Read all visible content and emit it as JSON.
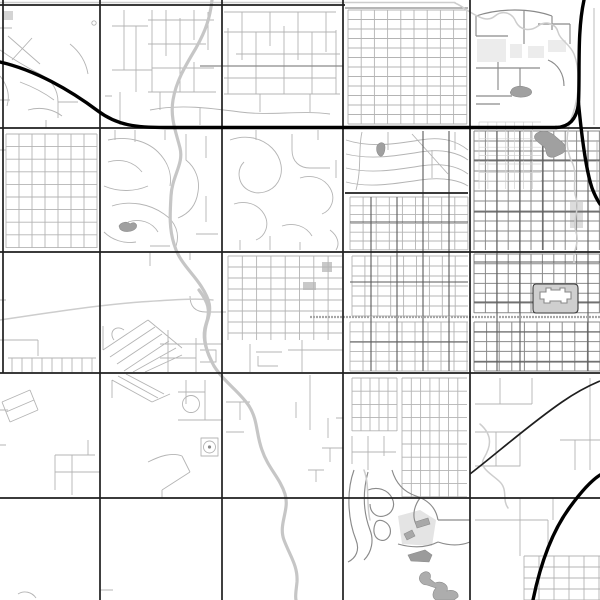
{
  "map": {
    "canvas": {
      "width": 600,
      "height": 600,
      "background": "#ffffff"
    },
    "palette": {
      "minor_street": "#b4b4b4",
      "mid_street": "#8a8a8a",
      "dark_street": "#5a5a5a",
      "major_road": "#1f1f1f",
      "highway": "#000000",
      "river": "#c6c6c6",
      "stream": "#cdcdcd",
      "rail": "#a6a6a6",
      "water_fill": "#a0a0a0",
      "area_fill": "#ececec",
      "building_fill": "#cfcfcf",
      "dark_structure": "#9b9b9b"
    },
    "layers": [
      {
        "name": "area-fills-layer",
        "kind": "fill",
        "fill": "#ececec",
        "items": [
          {
            "d": "M477 39 H506 V62 H477 Z"
          },
          {
            "d": "M510 44 H522 V58 H510 Z"
          },
          {
            "d": "M528 46 H544 V58 H528 Z"
          },
          {
            "d": "M548 40 H566 V52 H548 Z"
          },
          {
            "d": "M570 202 H583 V228 H570 Z",
            "f": "#dcdcdc"
          },
          {
            "d": "M3 11 H13 V20 H3 Z",
            "f": "#d4d4d4"
          },
          {
            "d": "M303 282 H316 V290 H303 Z",
            "f": "#c9c9c9"
          },
          {
            "d": "M322 262 H332 V272 H322 Z",
            "f": "#c9c9c9"
          },
          {
            "d": "M398 516 L420 510 L436 520 L432 546 L402 544 Z",
            "f": "#e4e4e4"
          }
        ]
      },
      {
        "name": "street-grids-layer",
        "kind": "grid",
        "stroke": "#b4b4b4",
        "width": 0.9,
        "items": [
          {
            "x0": 348,
            "y0": 10,
            "x1": 467,
            "y1": 124,
            "dx": 13.2,
            "dy": 9.5
          },
          {
            "x0": 350,
            "y0": 197,
            "x1": 468,
            "y1": 250,
            "dx": 13.1,
            "dy": 8.8
          },
          {
            "x0": 352,
            "y0": 256,
            "x1": 468,
            "y1": 316,
            "dx": 12.9,
            "dy": 10
          },
          {
            "x0": 350,
            "y0": 322,
            "x1": 468,
            "y1": 371,
            "dx": 13,
            "dy": 9.8
          },
          {
            "x0": 352,
            "y0": 378,
            "x1": 397,
            "y1": 431,
            "dx": 9,
            "dy": 13.2
          },
          {
            "x0": 402,
            "y0": 378,
            "x1": 467,
            "y1": 497,
            "dx": 9.3,
            "dy": 13.2
          },
          {
            "x0": 6,
            "y0": 134,
            "x1": 97,
            "y1": 248,
            "dx": 13,
            "dy": 12.6
          },
          {
            "x0": 524,
            "y0": 556,
            "x1": 600,
            "y1": 600,
            "dx": 15,
            "dy": 11
          },
          {
            "x0": 228,
            "y0": 256,
            "x1": 342,
            "y1": 340,
            "dx": 14.3,
            "dy": 11
          }
        ]
      },
      {
        "name": "downtown-grids-layer",
        "kind": "grid",
        "stroke": "#8a8a8a",
        "width": 1,
        "items": [
          {
            "x0": 474,
            "y0": 131,
            "x1": 600,
            "y1": 250,
            "dx": 11.4,
            "dy": 10
          },
          {
            "x0": 474,
            "y0": 254,
            "x1": 600,
            "y1": 313,
            "dx": 11.4,
            "dy": 9.8
          },
          {
            "x0": 474,
            "y0": 322,
            "x1": 600,
            "y1": 371,
            "dx": 12.6,
            "dy": 9.8
          }
        ]
      },
      {
        "name": "parking-grid-layer",
        "kind": "grid",
        "stroke": "#d2d2d2",
        "width": 0.7,
        "items": [
          {
            "x0": 479,
            "y0": 122,
            "x1": 541,
            "y1": 189,
            "dx": 8.9,
            "dy": 8.4
          }
        ]
      },
      {
        "name": "minor-streets-layer",
        "kind": "stroke",
        "stroke": "#b4b4b4",
        "width": 0.9,
        "items": [
          "M8 36 L40 64 M32 38 L12 60 M0 50 C14 60 28 68 40 74 C52 80 58 90 58 102 V118 M20 82 C36 88 46 94 54 100 M0 76 C8 86 10 96 7 106 M28 110 C42 106 54 110 62 116 M58 102 H78 M70 44 C80 52 86 62 88 74 M0 28 H12 M0 100 H10 M46 120 V128",
          "M152 10 V92 M166 10 V56 M180 18 V92 M194 10 V40 M194 62 V92 M208 12 V50 M124 10 V70 M136 26 V92 M112 26 H148 M112 70 H152 M148 20 H214 M148 44 H206 M152 68 H214 M148 92 H216",
          "M228 28 V94 M242 12 V60 M256 32 V94 M270 12 V46 M284 26 V94 M298 12 V60 M312 32 V94 M326 12 V52 M336 30 V94 M224 12 H336 M224 32 H336 M236 54 H340 M224 78 H336 M224 94 H340",
          "M150 110 C180 104 210 108 240 112 C270 116 300 110 330 114 M160 92 V110 M260 94 V112 M310 94 V112 M120 92 V125 M200 108 V125 M105 96 H112",
          "M108 140 C126 136 146 140 158 152 C168 162 172 174 170 186 M108 162 C122 158 134 162 142 172 M104 186 C118 192 134 192 148 186 M112 206 C130 200 150 204 164 214 C176 222 180 234 176 246 M128 222 C140 218 152 222 158 232 M104 232 C112 240 124 244 136 242 M150 246 H170 M186 134 V160 C196 168 200 180 198 192 C196 206 188 214 178 218 M206 136 V158 M206 196 V222 M196 234 H218 M115 130 V140 M135 130 V142 M165 130 V140",
          "M230 140 C246 134 262 138 272 148 C282 158 284 172 278 182 C272 192 258 196 248 190 C238 184 236 170 244 162 M292 134 V150 C292 162 300 168 310 168 H330 M300 178 C312 174 324 178 330 188 C336 198 332 210 322 214 M234 204 C246 200 258 204 264 214 C270 224 266 236 256 240 M282 226 C294 222 306 226 312 236 M318 140 V130 M256 130 V140 M336 160 V178 M330 230 C338 236 340 244 336 250 M240 250 V240 M300 250 V242 M270 250 V236",
          "M346 140 C370 148 396 144 420 140 C444 136 458 142 468 150 M346 154 C370 160 396 156 420 152 C444 148 460 154 468 160 M346 168 C370 174 396 170 420 166 C446 162 460 168 468 174 M346 182 C368 188 394 184 420 180 C446 176 462 182 468 186 M362 132 C358 148 362 168 356 190 M412 134 L448 174 M388 132 V150 M432 150 V178 M455 132 V150",
          "M190 296 Q190 312 206 312 H226 M103 350 L148 320 M110 357 L155 327 M117 364 L162 334 M124 371 L169 341 M133 372 L176 348 M145 372 L182 355 M103 326 V350 M148 320 L182 348 M114 340 C108 332 116 324 124 330 M168 330 V372 M196 338 V372 M160 344 H222 M160 358 H196 M200 350 H216 V362 H200 M150 252 V266 M190 252 V260",
          "M8 358 H96 M12 358 V372 M22 358 V372 M32 358 V372 M42 358 V372 M52 358 V372 M62 358 V372 M72 358 V372 M82 358 V372 M92 358 V372 M0 340 H38 M38 340 V356 M0 300 H6 M0 150 H6",
          "M250 344 V372 M302 340 V372 M288 350 H343 M256 352 H282 M258 356 V366 H278",
          "M2 402 L30 390 M6 412 L34 400 M10 422 L38 410 M2 402 L10 422 M30 390 L38 410 M55 455 H95 M55 455 V490 M72 455 V495 M55 472 H100 M88 440 V455 M0 410 H8 M0 445 H6",
          "M112 380 L152 402 M118 376 L158 398 M126 374 L164 394 M112 380 V398 M152 402 L170 394 M186 380 V404 M178 392 H205 M205 380 V420 M178 420 H222 M148 462 C160 456 172 452 182 456 M182 456 L190 472 M162 490 L190 472 M162 490 V498 M201 438 H218 V456 H201 Z",
          "M226 402 H250 M240 402 V420 M226 432 H244 M310 375 V430 M296 402 V418 M336 418 H343 M328 418 V438 M322 448 H343 M330 448 V462 M308 470 H324 M316 470 V482",
          "M352 436 V464 M368 436 V470 M384 436 V456 M352 452 H396",
          "M475 404 H532 M500 378 V404 M532 378 V404 M475 432 H520 V466 H475 M496 432 V466 M590 378 V470 M560 440 H600 M575 440 V470 M475 520 H548 M520 498 V556 M548 520 V545 M553 498 V520",
          "M594 8 V125 M597 140 V190",
          "M18 594 C24 590 32 592 36 598 M100 590 H113"
        ]
      },
      {
        "name": "collector-streets-layer",
        "kind": "stroke",
        "stroke": "#8a8a8a",
        "width": 1.15,
        "items": [
          "M200 66 H343",
          "M345 8 H468",
          "M476 16 C500 8 530 8 552 16 M476 16 V36 M552 16 V30 M476 36 H508 M524 10 V44 M538 24 H570 M570 24 V44 M476 68 H540 M498 62 V90 M520 68 V96 M476 96 H512 M548 60 C558 64 564 74 564 86 M476 104 H500",
          "M354 470 C346 492 348 520 356 540 C360 550 356 558 348 562 M368 472 C362 494 364 514 370 530 C374 540 372 552 364 560 M368 490 C378 486 388 490 392 498 C396 506 392 514 384 516 C376 518 370 512 370 504 M392 470 C396 484 404 492 416 496 C428 500 436 508 438 520 M398 544 C412 548 426 548 438 542 M420 498 C414 506 412 516 416 524 M438 520 H470 M438 542 C450 546 460 546 470 542 M376 522 C372 530 374 538 380 540 C386 542 392 536 390 528 C388 522 380 518 376 522"
        ]
      },
      {
        "name": "downtown-accent-streets-layer",
        "kind": "stroke",
        "stroke": "#5a5a5a",
        "width": 1.1,
        "items": [
          "M497 131 V371 M520 131 V371 M543 131 V250 M588 131 V371",
          "M474 160 H600 M474 212 H600 M474 262 H600 M474 302 H600 M474 332 H600 M474 362 H600",
          "M371 197 V371 M397 197 V371 M423 131 V371 M449 131 V371",
          "M350 222 H468 M350 282 H468 M350 342 H468"
        ]
      },
      {
        "name": "stream-layer",
        "kind": "stroke",
        "stroke": "#cdcdcd",
        "width": 1.5,
        "cap": "round",
        "items": [
          "M0 2.5 H455",
          "M455 3 C462 6 466 10 470 12 C480 18 488 22 495 16 C502 10 512 12 516 22 C520 30 530 32 538 26 C546 20 556 24 558 32 C560 40 570 44 574 54 C578 64 579 76 578 90 C577 100 574 112 570 122",
          "M570 122 C566 136 566 150 572 162 C578 174 572 186 576 198 C580 210 572 220 576 232 C580 244 572 252 574 262",
          "M0 320 C40 314 90 306 140 302 C170 300 195 298 213 300",
          "M480 424 C494 436 490 448 484 458 C478 468 492 474 500 482 C508 490 502 500 508 508",
          "M364 470 C370 486 366 504 370 520"
        ]
      },
      {
        "name": "river-layer",
        "kind": "stroke",
        "stroke": "#c6c6c6",
        "width": 3.2,
        "cap": "round",
        "items": [
          "M212 0 C210 18 206 30 196 48 C184 68 176 82 173 100 C170 118 176 132 180 148 C184 164 172 176 171 196 C170 214 169 228 174 244 C179 262 192 272 201 286 C210 300 212 308 207 322 C202 338 206 352 214 366 C224 382 240 392 249 406 C258 420 256 434 262 450 C268 468 280 478 285 494 C290 510 278 524 284 540 C290 556 298 566 297 582 C296 592 295 596 296 600",
          "M199 290 C208 302 211 310 206 324 C202 336 205 348 212 362"
        ]
      },
      {
        "name": "railroad-layer",
        "kind": "stroke",
        "stroke": "#a6a6a6",
        "width": 2.2,
        "dash": "2 1",
        "items": [
          "M310 317 H600"
        ]
      },
      {
        "name": "major-roads-layer",
        "kind": "stroke",
        "stroke": "#1f1f1f",
        "width": 1.7,
        "items": [
          "M0 5 H345",
          "M0 128 H600",
          "M0 252 H600",
          "M0 373 H600",
          "M0 498 H600",
          "M3 0 V373",
          "M100 0 V600",
          "M222 0 V600",
          "M343 0 V600",
          "M470 0 V600",
          "M345 193 H468",
          "M470 474 C496 454 530 424 562 402 C575 393 588 386 600 381"
        ]
      },
      {
        "name": "highway-layer",
        "kind": "stroke",
        "stroke": "#000000",
        "width": 3.4,
        "cap": "round",
        "items": [
          "M0 62 C35 70 70 90 98 111 C118 126 138 127.5 165 127.5 H556",
          "M556 127.5 C570 127 577 118 578.5 103 C580 70 577 32 584 0",
          "M578.5 103 C582 140 586 170 592 188 C595 196 598 201 600 204",
          "M533 600 C541 561 553 530 570 507 C578 496 589 482 600 475"
        ]
      },
      {
        "name": "water-bodies-layer",
        "kind": "fill",
        "fill": "#a0a0a0",
        "stroke": "#8c8c8c",
        "width": 0.6,
        "items": [
          {
            "d": "M511 91 C512 87 519 85 525 87 C530 88 533 91 531 94 C527 98 517 98 512 95 C510 94 510 92 511 91 Z"
          },
          {
            "d": "M537 133 C544 129 551 132 556 137 L563 143 C567 147 566 152 561 154 C557 156 552 159 548 156 C545 153 547 149 544 147 L538 142 C534 139 533 136 537 133 Z"
          },
          {
            "d": "M119 226 C121 222 127 221 130 224 C134 221 138 224 136 228 C133 232 124 233 120 229 Z"
          },
          {
            "d": "M377 146 C380 141 385 142 385 147 C385 152 383 157 380 156 C377 154 376 150 377 146 Z"
          },
          {
            "d": "M421 574 C427 569 432 573 430 579 L435 583 C442 580 449 585 447 591 C453 589 459 592 458 597 L454 600 L436 600 C431 597 433 591 436 588 L427 585 C421 585 417 579 421 574 Z",
            "f": "#adadad"
          },
          {
            "d": "M408 555 L425 550 L432 555 L429 562 L411 561 Z",
            "f": "#9b9b9b"
          },
          {
            "d": "M415 522 L428 518 L430 524 L417 528 Z",
            "f": "#a8a8a8"
          },
          {
            "d": "M404 534 L412 530 L415 536 L407 540 Z",
            "f": "#a8a8a8"
          }
        ]
      },
      {
        "name": "capitol-block-layer",
        "kind": "fill",
        "fill": "#cfcfcf",
        "stroke": "#3a3a3a",
        "width": 1.1,
        "items": [
          {
            "d": "M536 284 H574 Q578 284 578 288 V309 Q578 313 574 313 H536 Q533 313 533 309 V288 Q533 284 536 284 Z"
          },
          {
            "d": "M540 292 h6 v-4 h5 v2 h9 v-2 h5 v4 h6 v7 h-4 v4 h-6 v-2 h-11 v2 h-6 v-4 h-4 Z",
            "f": "#ffffff",
            "s": "#8a8a8a"
          }
        ]
      },
      {
        "name": "map-symbols-layer",
        "kind": "circle",
        "items": [
          {
            "cx": 191,
            "cy": 404,
            "r": 8.5,
            "s": "#b4b4b4",
            "w": 0.9
          },
          {
            "cx": 209.5,
            "cy": 447,
            "r": 6,
            "s": "#b4b4b4",
            "w": 0.9
          },
          {
            "cx": 209.5,
            "cy": 447,
            "r": 1.6,
            "f": "#8a8a8a"
          },
          {
            "cx": 94,
            "cy": 23,
            "r": 2.2,
            "s": "#b4b4b4",
            "w": 0.9
          }
        ]
      }
    ]
  }
}
